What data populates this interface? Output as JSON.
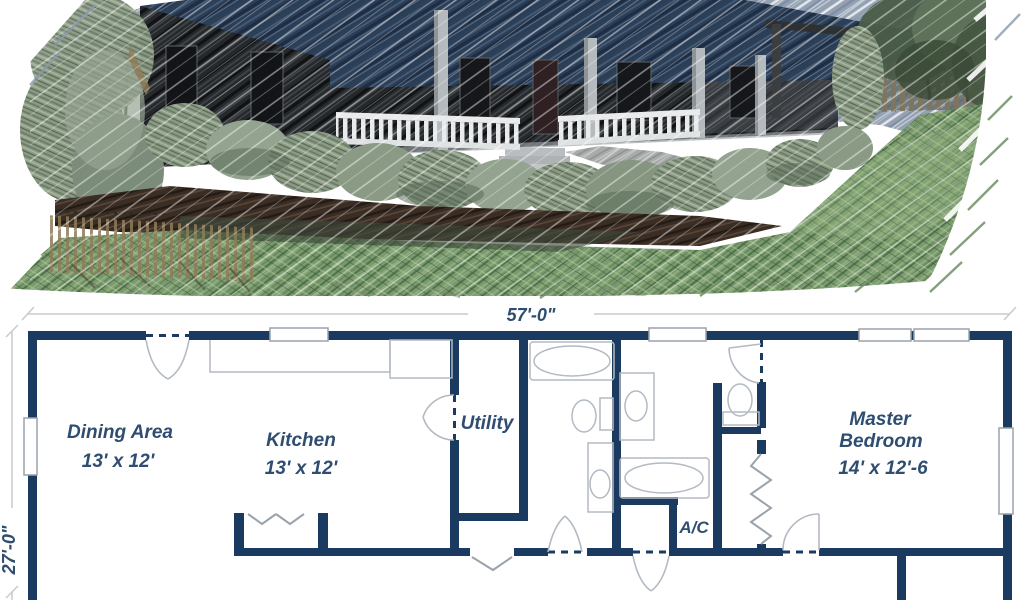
{
  "rendering": {
    "alt": "Pencil-watercolor sketch of a single-story ranch home with dark blue roof, full-width covered porch with white railing, foundation shrubs, mulch beds, picket fences and a sloping green lawn",
    "colors": {
      "sky": "#93a1b3",
      "roof": "#2b3e56",
      "siding": "#26292c",
      "porch_post": "#b5babe",
      "railing": "#e8eaeb",
      "foliage": "#8a9a85",
      "mulch": "#3a2d24",
      "lawn": "#7a9b6d",
      "fence": "#7d7562"
    }
  },
  "floor_plan": {
    "dimensions": {
      "width": "57'-0\"",
      "depth": "27'-0\""
    },
    "rooms": {
      "dining": {
        "name": "Dining Area",
        "dims": "13' x 12'"
      },
      "kitchen": {
        "name": "Kitchen",
        "dims": "13' x 12'"
      },
      "utility": {
        "name": "Utility"
      },
      "ac": {
        "name": "A/C"
      },
      "master": {
        "name_line1": "Master",
        "name_line2": "Bedroom",
        "dims": "14' x 12'-6"
      }
    },
    "colors": {
      "wall": "#1b3a60",
      "label": "#2e4d71",
      "fixture": "#b3bac2",
      "window_frame": "#9aa2ac",
      "dimension_line": "#c5cbd1"
    }
  }
}
